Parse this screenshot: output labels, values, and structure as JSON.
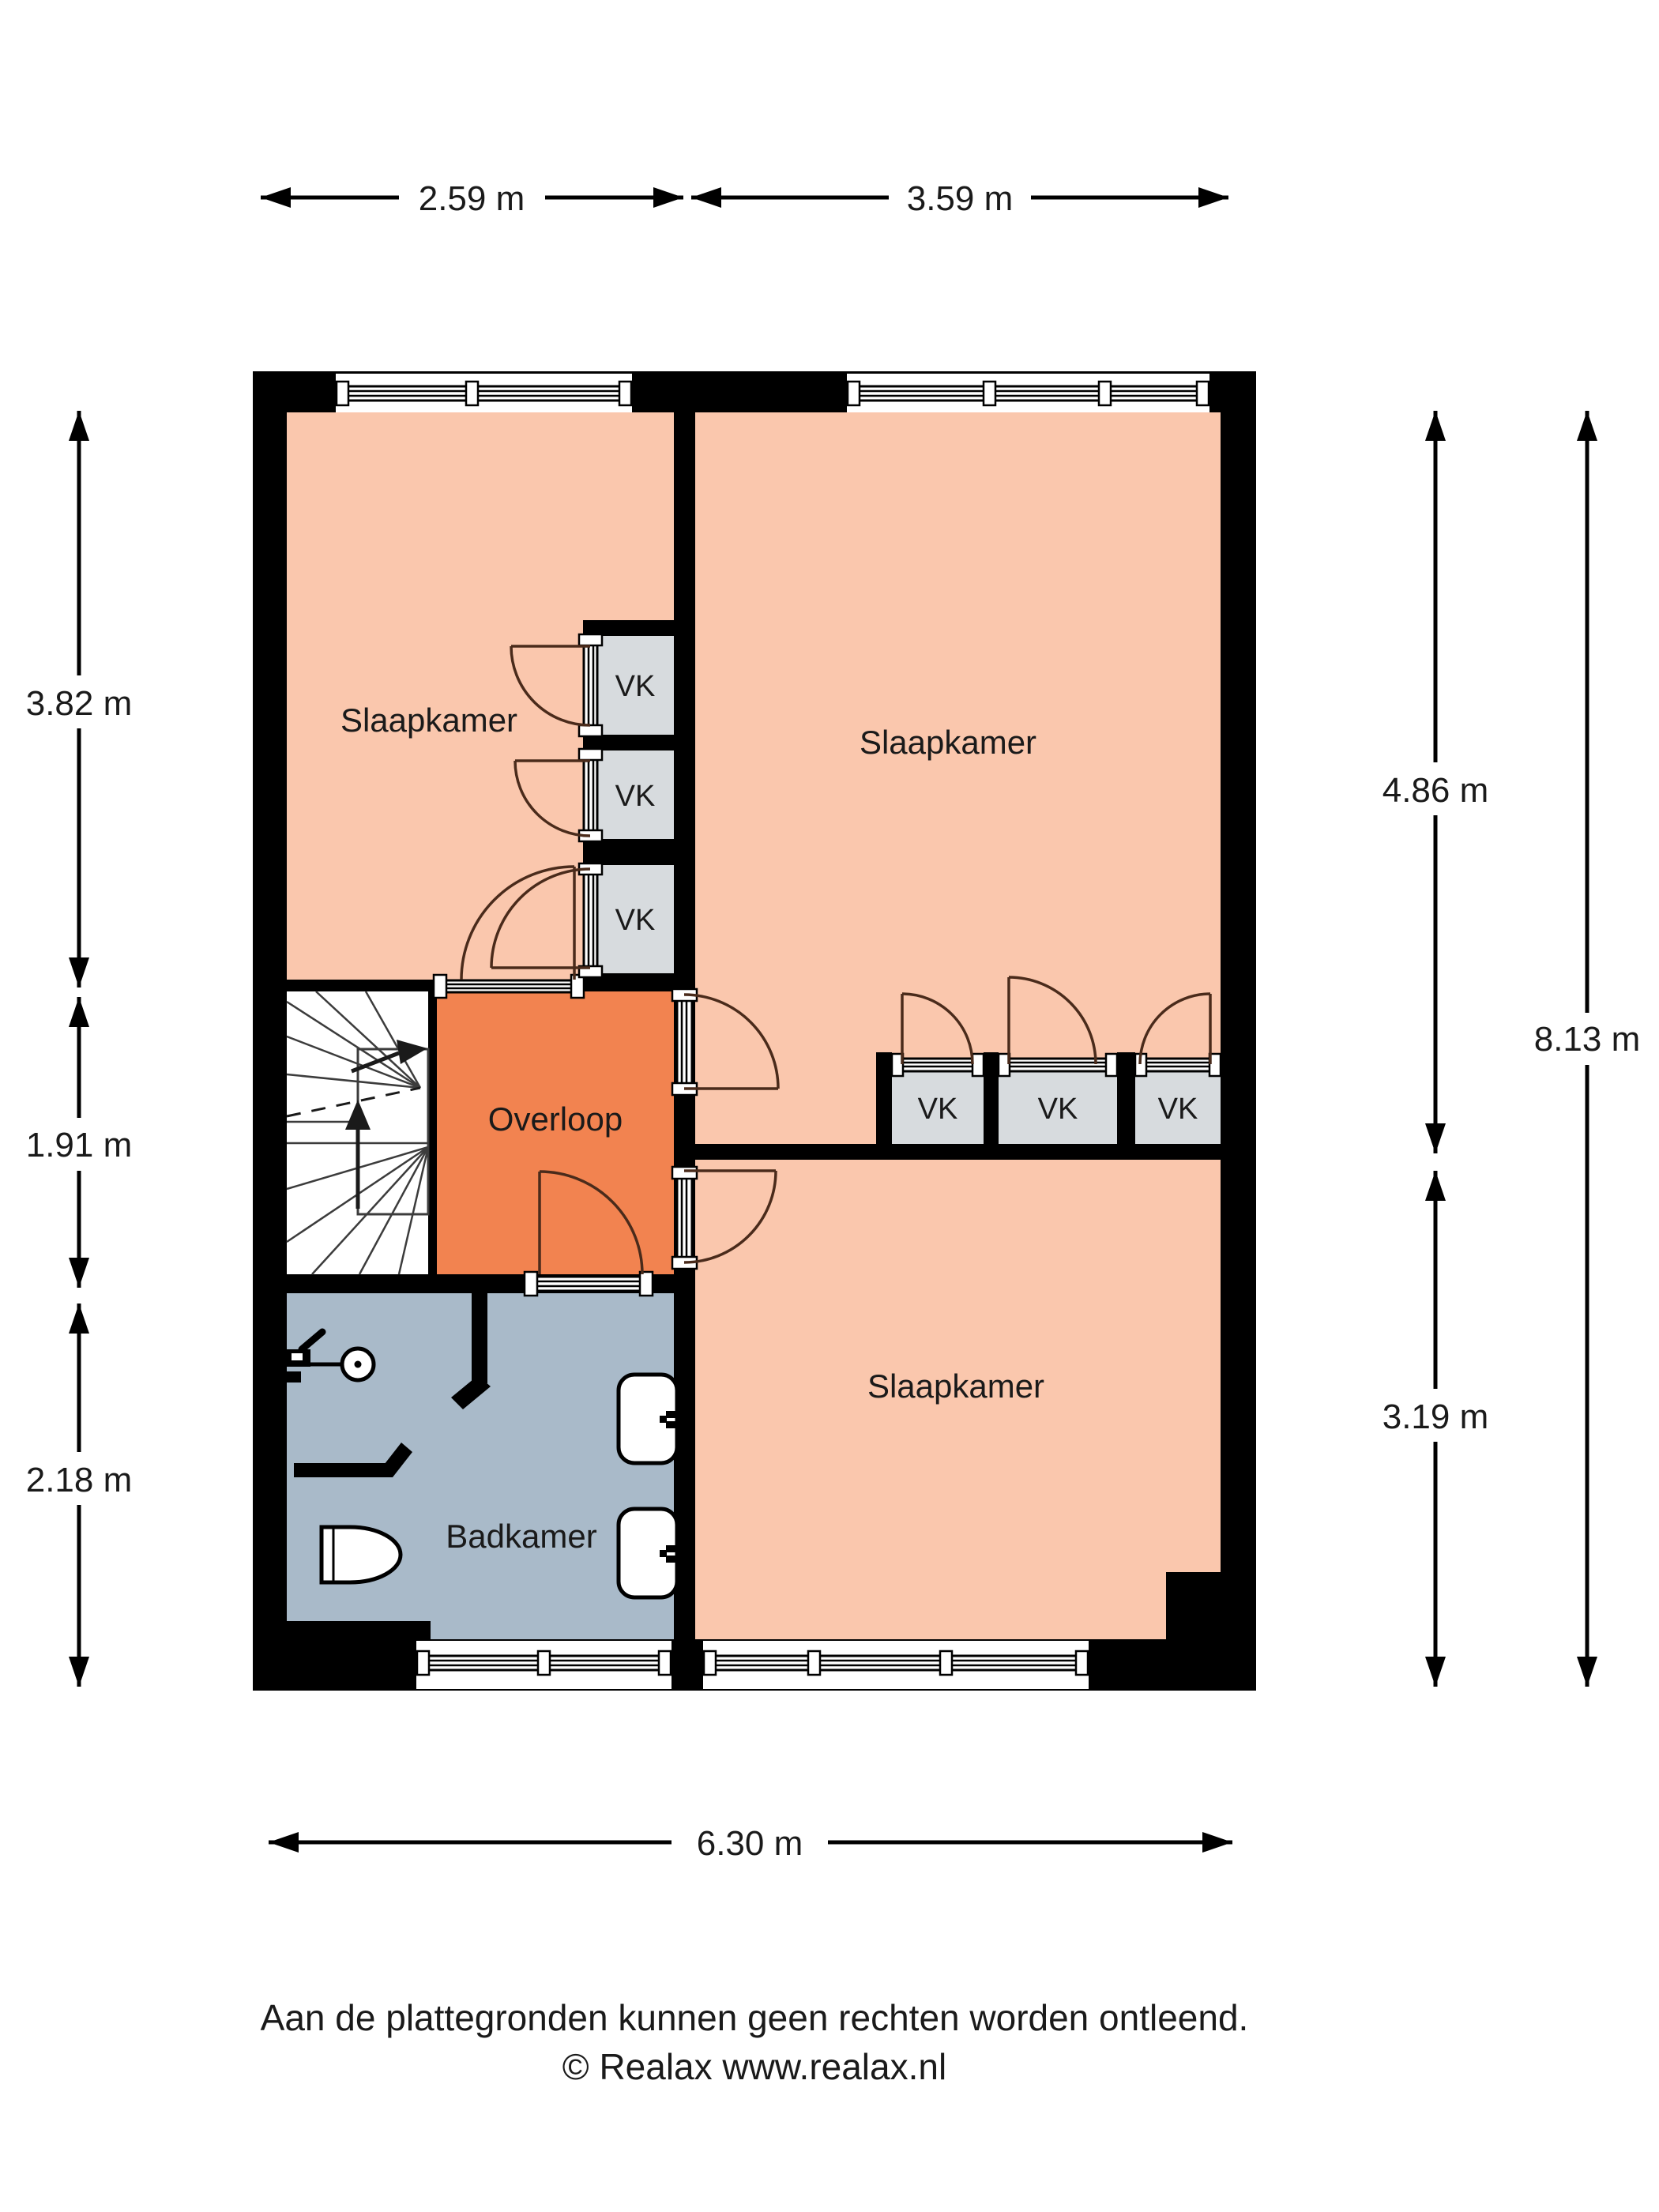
{
  "page": {
    "background": "#ffffff"
  },
  "colors": {
    "wall": "#000000",
    "room_bedroom": "#FAC7AD",
    "room_hall": "#F28350",
    "room_bath": "#A9BAC9",
    "closet": "#D7DBDE",
    "stairs": "#FFFFFF",
    "door_arc": "#4A2B1B",
    "text": "#1A1A1A"
  },
  "labels": {
    "bedroom": "Slaapkamer",
    "hall": "Overloop",
    "bath": "Badkamer",
    "closet": "VK"
  },
  "dimensions": {
    "top_left": "2.59 m",
    "top_right": "3.59 m",
    "left_upper": "3.82 m",
    "left_middle": "1.91 m",
    "left_lower": "2.18 m",
    "right_upper": "4.86 m",
    "right_lower": "3.19 m",
    "right_total": "8.13 m",
    "bottom": "6.30 m"
  },
  "footer": {
    "disclaimer": "Aan de plattegronden kunnen geen rechten worden ontleend.",
    "copyright": "© Realax www.realax.nl"
  }
}
